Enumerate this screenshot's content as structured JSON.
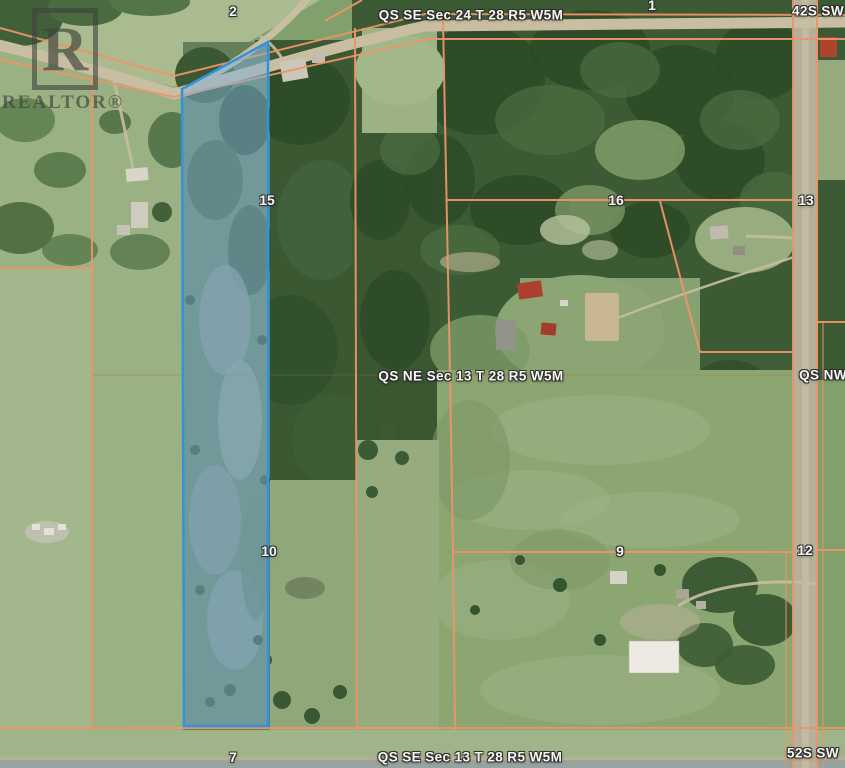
{
  "watermark": {
    "letter": "R",
    "brand": "REALTOR®"
  },
  "labels": {
    "section_top": "QS SE Sec 24 T 28 R5 W5M",
    "section_middle": "QS NE Sec 13 T 28 R5 W5M",
    "section_bottom": "QS SE Sec 13 T 28 R5 W5M",
    "quarter_right": "QS NW",
    "road_top_right": "42S SW",
    "road_bottom_right": "52S SW",
    "lsd_2": "2",
    "lsd_1": "1",
    "lsd_15": "15",
    "lsd_16": "16",
    "lsd_13": "13",
    "lsd_10": "10",
    "lsd_9": "9",
    "lsd_12": "12",
    "lsd_7": "7"
  },
  "colors": {
    "boundary_line": "#ec9568",
    "parcel_fill": "#7fb2d9",
    "parcel_stroke": "#3293dd"
  }
}
